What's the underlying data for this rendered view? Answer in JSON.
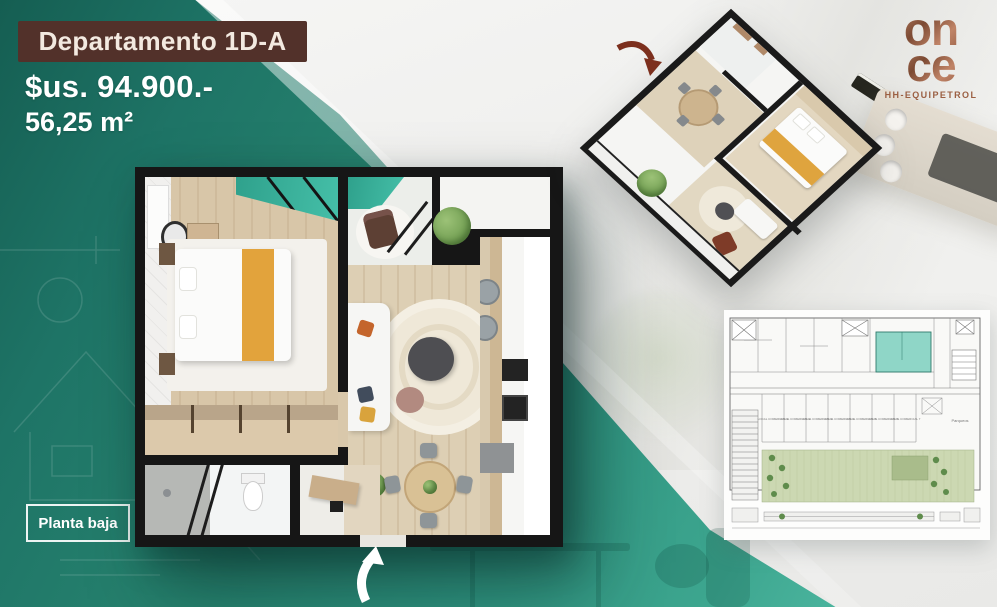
{
  "flyer": {
    "title": "Departamento 1D-A",
    "price": "$us. 94.900.-",
    "area": "56,25 m²",
    "floor_badge": "Planta baja"
  },
  "logo": {
    "word_top": "on",
    "word_bottom": "ce",
    "tagline": "HH-EQUIPETROL"
  },
  "colors": {
    "teal_dark": "#155e52",
    "teal": "#2f9480",
    "teal_light": "#55bfa9",
    "title_brown": "#52312a",
    "title_cream": "#f3e9e0",
    "logo_copper": "#9b5f42",
    "wall_black": "#161616",
    "bed_throw_yellow": "#e2a33c",
    "unit_highlight": "#8fd6c7"
  },
  "building_plan": {
    "units": [
      "LOCAL COMERCIAL 1",
      "LOCAL COMERCIAL 2",
      "LOCAL COMERCIAL 3",
      "LOCAL COMERCIAL 4",
      "LOCAL COMERCIAL 5",
      "LOCAL COMERCIAL 6",
      "LOCAL COMERCIAL 7"
    ],
    "parking_label": "Parqueos"
  }
}
